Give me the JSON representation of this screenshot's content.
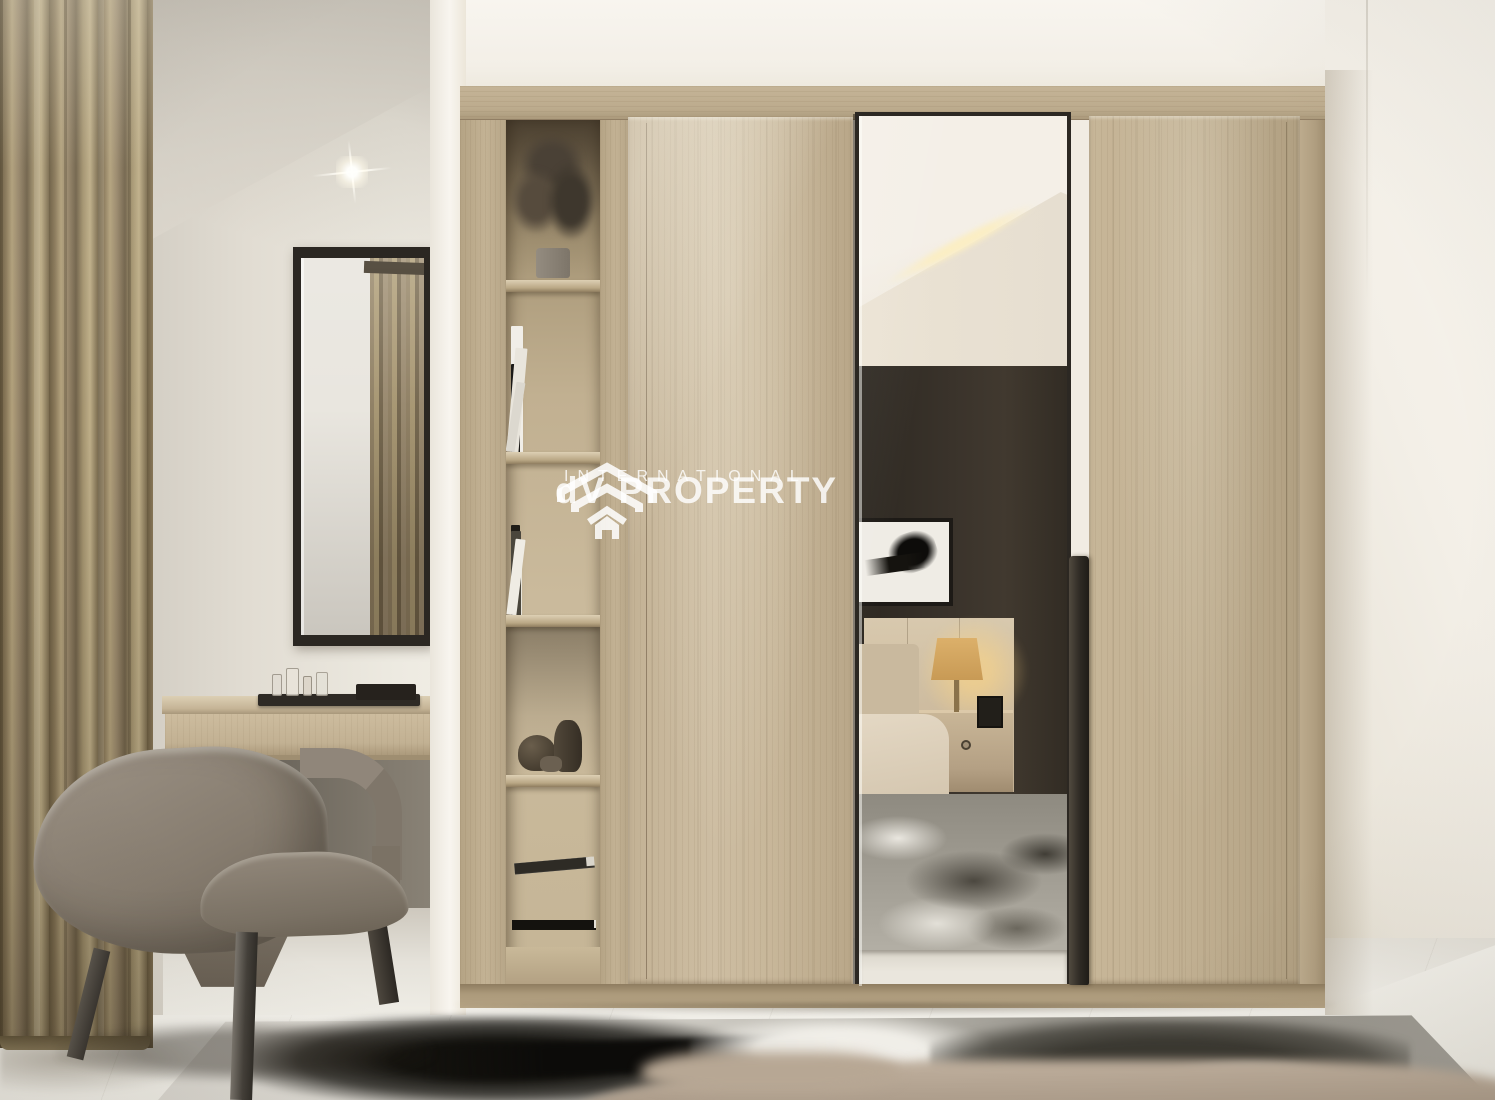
{
  "watermark": {
    "logo": "house-chevrons-logo",
    "line1": "dV PROPERTY",
    "line2": "INTERNATIONAL",
    "text_color": "#ffffff"
  },
  "scene": {
    "description": "3D interior render of a bedroom dressing area",
    "elements": [
      "curtains",
      "accent chair",
      "striped cushion",
      "wall mirror",
      "vanity console",
      "glass tray set",
      "wardrobe",
      "bookshelf niche",
      "plant",
      "books",
      "pottery",
      "mirrored door",
      "door handle",
      "bedroom reflection",
      "bed",
      "nightstand",
      "table lamp",
      "framed artwork",
      "area rug",
      "marble floor",
      "ceiling spotlight"
    ],
    "palette": {
      "wood": "#c8b79a",
      "wall": "#f1ece3",
      "curtain": "#97866a",
      "chair": "#847a6d",
      "floor": "#eeece6",
      "rug_dark": "#1b1a16",
      "reflection_wall": "#3a332b",
      "lamp_glow": "#e8c06a"
    }
  }
}
